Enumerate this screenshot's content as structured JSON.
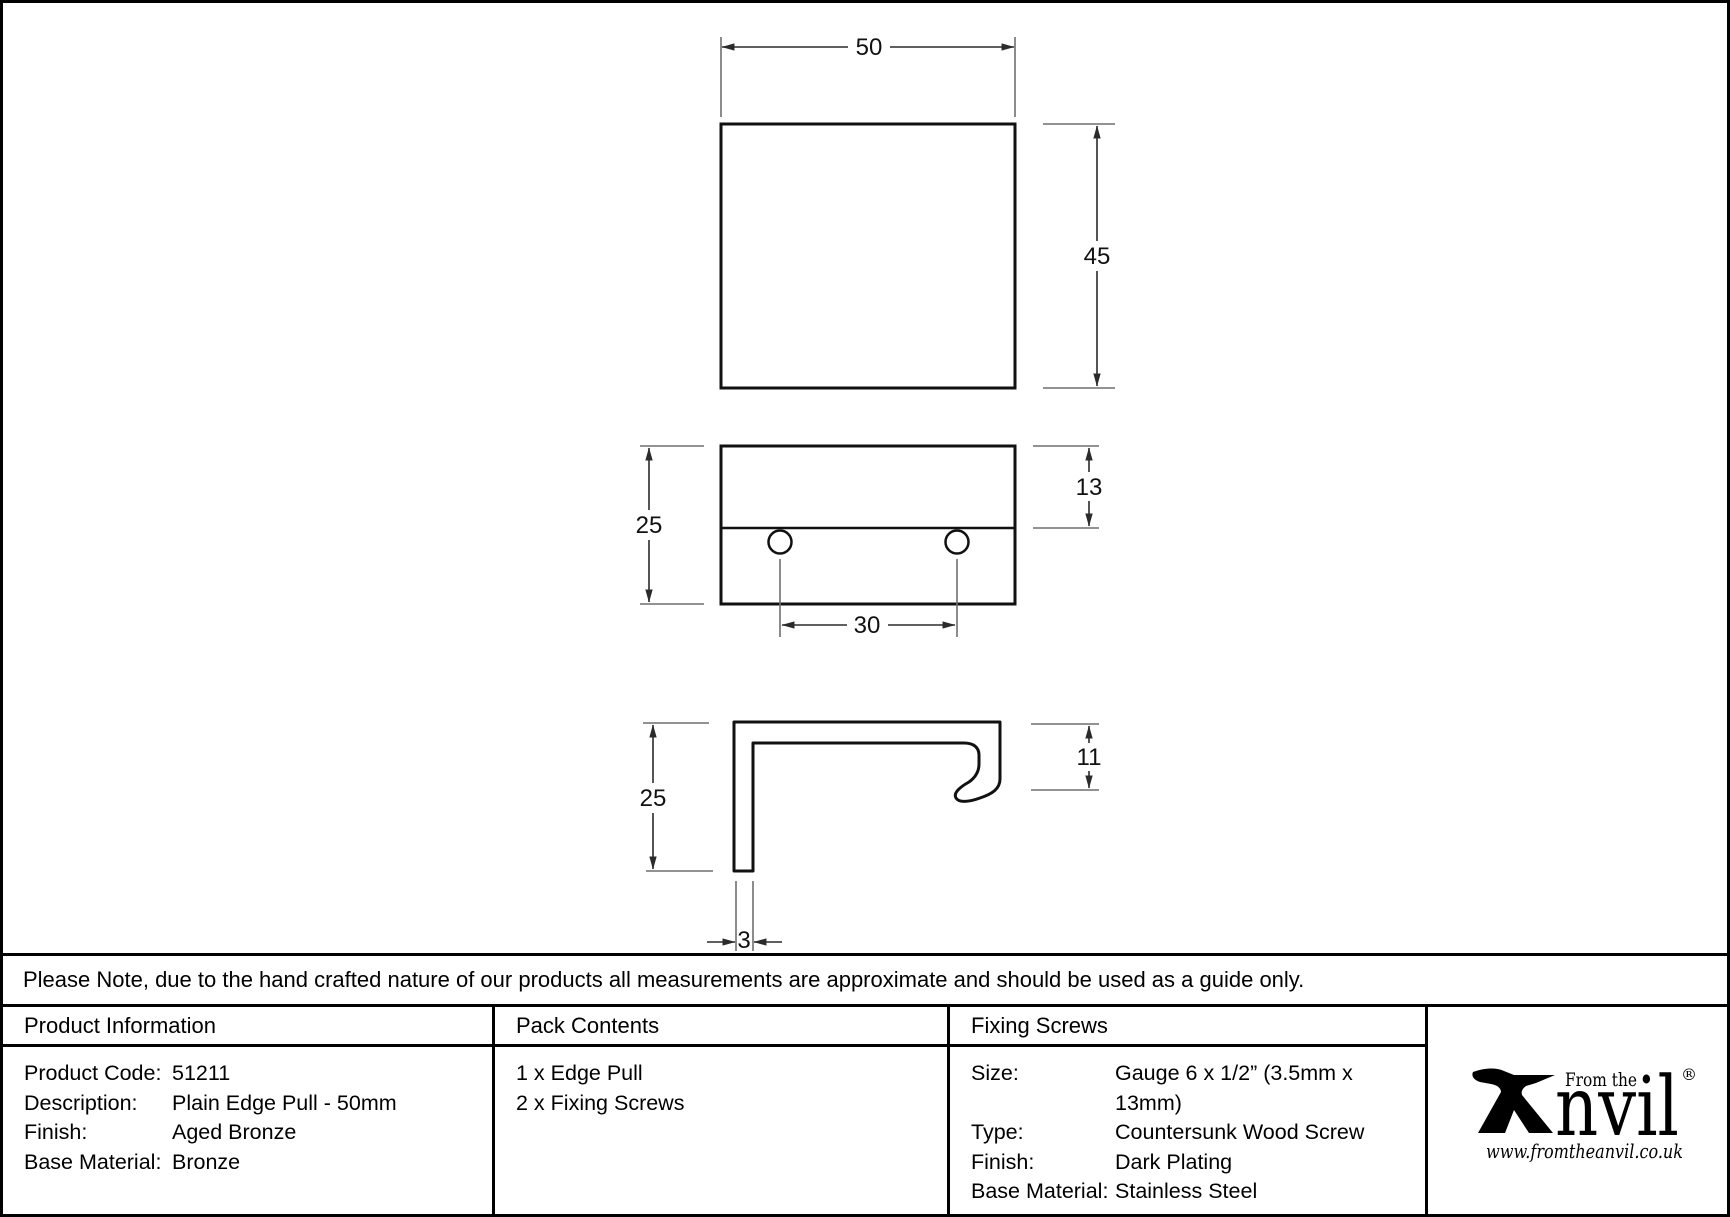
{
  "note": "Please Note, due to the hand crafted nature of our products all measurements are approximate and should be used as a guide only.",
  "drawing": {
    "dimensions": {
      "top_view_width": "50",
      "top_view_height": "45",
      "front_view_height": "25",
      "front_view_top_section": "13",
      "hole_spacing": "30",
      "side_view_height": "25",
      "side_view_lip": "11",
      "side_view_thickness": "3"
    }
  },
  "table": {
    "product_info": {
      "header": "Product Information",
      "rows": [
        {
          "label": "Product Code:",
          "value": "51211"
        },
        {
          "label": "Description:",
          "value": "Plain Edge Pull - 50mm"
        },
        {
          "label": "Finish:",
          "value": "Aged Bronze"
        },
        {
          "label": "Base Material:",
          "value": "Bronze"
        }
      ]
    },
    "pack_contents": {
      "header": "Pack Contents",
      "items": [
        "1 x Edge Pull",
        "2 x Fixing Screws"
      ]
    },
    "fixing_screws": {
      "header": "Fixing Screws",
      "rows": [
        {
          "label": "Size:",
          "value": "Gauge 6 x 1/2” (3.5mm x 13mm)"
        },
        {
          "label": "Type:",
          "value": "Countersunk Wood Screw"
        },
        {
          "label": "Finish:",
          "value": "Dark Plating"
        },
        {
          "label": "Base Material:",
          "value": "Stainless Steel"
        }
      ]
    }
  },
  "logo": {
    "tagline": "From the",
    "brand_suffix": "nvil",
    "registered": "®",
    "url": "www.fromtheanvil.co.uk"
  },
  "colors": {
    "outline": "#111111",
    "dim_line": "#3d3d3d",
    "ext_line": "#8a8a8a",
    "background": "#ffffff",
    "text": "#000000"
  }
}
